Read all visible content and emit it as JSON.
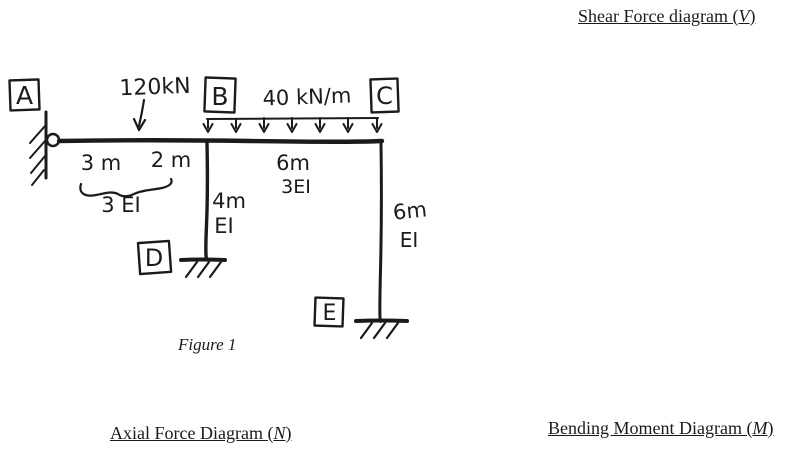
{
  "page": {
    "background": "#ffffff",
    "ink_color": "#1b1b1b"
  },
  "headings": {
    "shear": {
      "prefix": "Shear Force diagram (",
      "symbol": "V",
      "suffix": ")"
    },
    "axial": {
      "prefix": "Axial Force Diagram (",
      "symbol": "N",
      "suffix": ")"
    },
    "bending": {
      "prefix": "Bending Moment Diagram (",
      "symbol": "M",
      "suffix": ")"
    }
  },
  "figure": {
    "caption": "Figure 1",
    "nodes": {
      "a": "A",
      "b": "B",
      "c": "C",
      "d": "D",
      "e": "E"
    },
    "loads": {
      "point": "120kN",
      "distributed": "40 kN/m"
    },
    "dims": {
      "ab_seg1": "3 m",
      "ab_seg2": "2 m",
      "ab_ei": "3 EI",
      "bd_len": "4m",
      "bd_ei": "EI",
      "bc_len": "6m",
      "bc_ei": "3EI",
      "ce_len": "6m",
      "ce_ei": "EI"
    }
  }
}
